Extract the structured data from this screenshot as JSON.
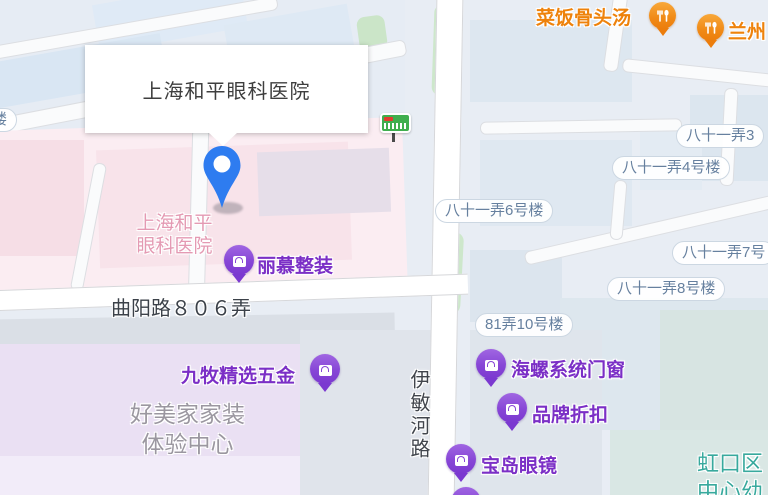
{
  "infowindow": {
    "title": "上海和平眼科医院"
  },
  "labels": {
    "hospital": {
      "line1": "上海和平",
      "line2": "眼科医院"
    },
    "homedecor": {
      "line1": "好美家家装",
      "line2": "体验中心"
    },
    "road_horizontal": "曲阳路８０６弄",
    "road_vertical": "伊敏河路",
    "district": {
      "line1": "虹口区",
      "line2": "中心幼"
    },
    "edge_left_partial": "楼"
  },
  "building_pills": [
    {
      "text": "八十一弄3"
    },
    {
      "text": "八十一弄4号楼"
    },
    {
      "text": "八十一弄6号楼"
    },
    {
      "text": "八十一弄7号"
    },
    {
      "text": "八十一弄8号楼"
    },
    {
      "text": "81弄10号楼"
    }
  ],
  "pois_shopping": [
    {
      "label": "丽慕整装"
    },
    {
      "label": "九牧精选五金"
    },
    {
      "label": "海螺系统门窗"
    },
    {
      "label": "品牌折扣"
    },
    {
      "label": "宝岛眼镜"
    }
  ],
  "pois_food": [
    {
      "label": "菜饭骨头汤"
    },
    {
      "label": "兰州"
    }
  ],
  "colors": {
    "poi_purple": "#7b2fc6",
    "poi_orange": "#ee820b",
    "pin_blue": "#2e7cf0",
    "hospital_pink_text": "#e49ab3",
    "district_teal_text": "#38a99d",
    "bus_green": "#3fae4e"
  }
}
